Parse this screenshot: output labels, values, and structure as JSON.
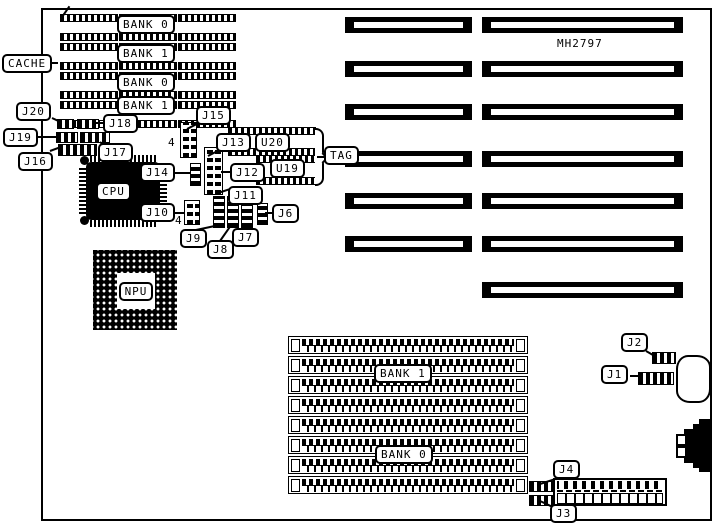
{
  "colors": {
    "ink": "#000000",
    "paper": "#ffffff"
  },
  "board": {
    "model": "MH2797"
  },
  "cache": {
    "label": "CACHE",
    "banks": [
      {
        "label": "BANK 0"
      },
      {
        "label": "BANK 1"
      },
      {
        "label": "BANK 0"
      },
      {
        "label": "BANK 1"
      }
    ]
  },
  "chips": {
    "cpu": "CPU",
    "npu": "NPU",
    "u20": "U20",
    "u19": "U19",
    "tag": "TAG"
  },
  "jumpers": {
    "j1": "J1",
    "j2": "J2",
    "j3": "J3",
    "j4": "J4",
    "j6": "J6",
    "j7": "J7",
    "j8": "J8",
    "j9": "J9",
    "j10": "J10",
    "j11": "J11",
    "j12": "J12",
    "j13": "J13",
    "j14": "J14",
    "j15": "J15",
    "j16": "J16",
    "j17": "J17",
    "j18": "J18",
    "j19": "J19",
    "j20": "J20"
  },
  "annotations": {
    "j15_pin4": "4",
    "j10_pin4": "4"
  },
  "simm": {
    "bank1": "BANK 1",
    "bank0": "BANK 0"
  }
}
